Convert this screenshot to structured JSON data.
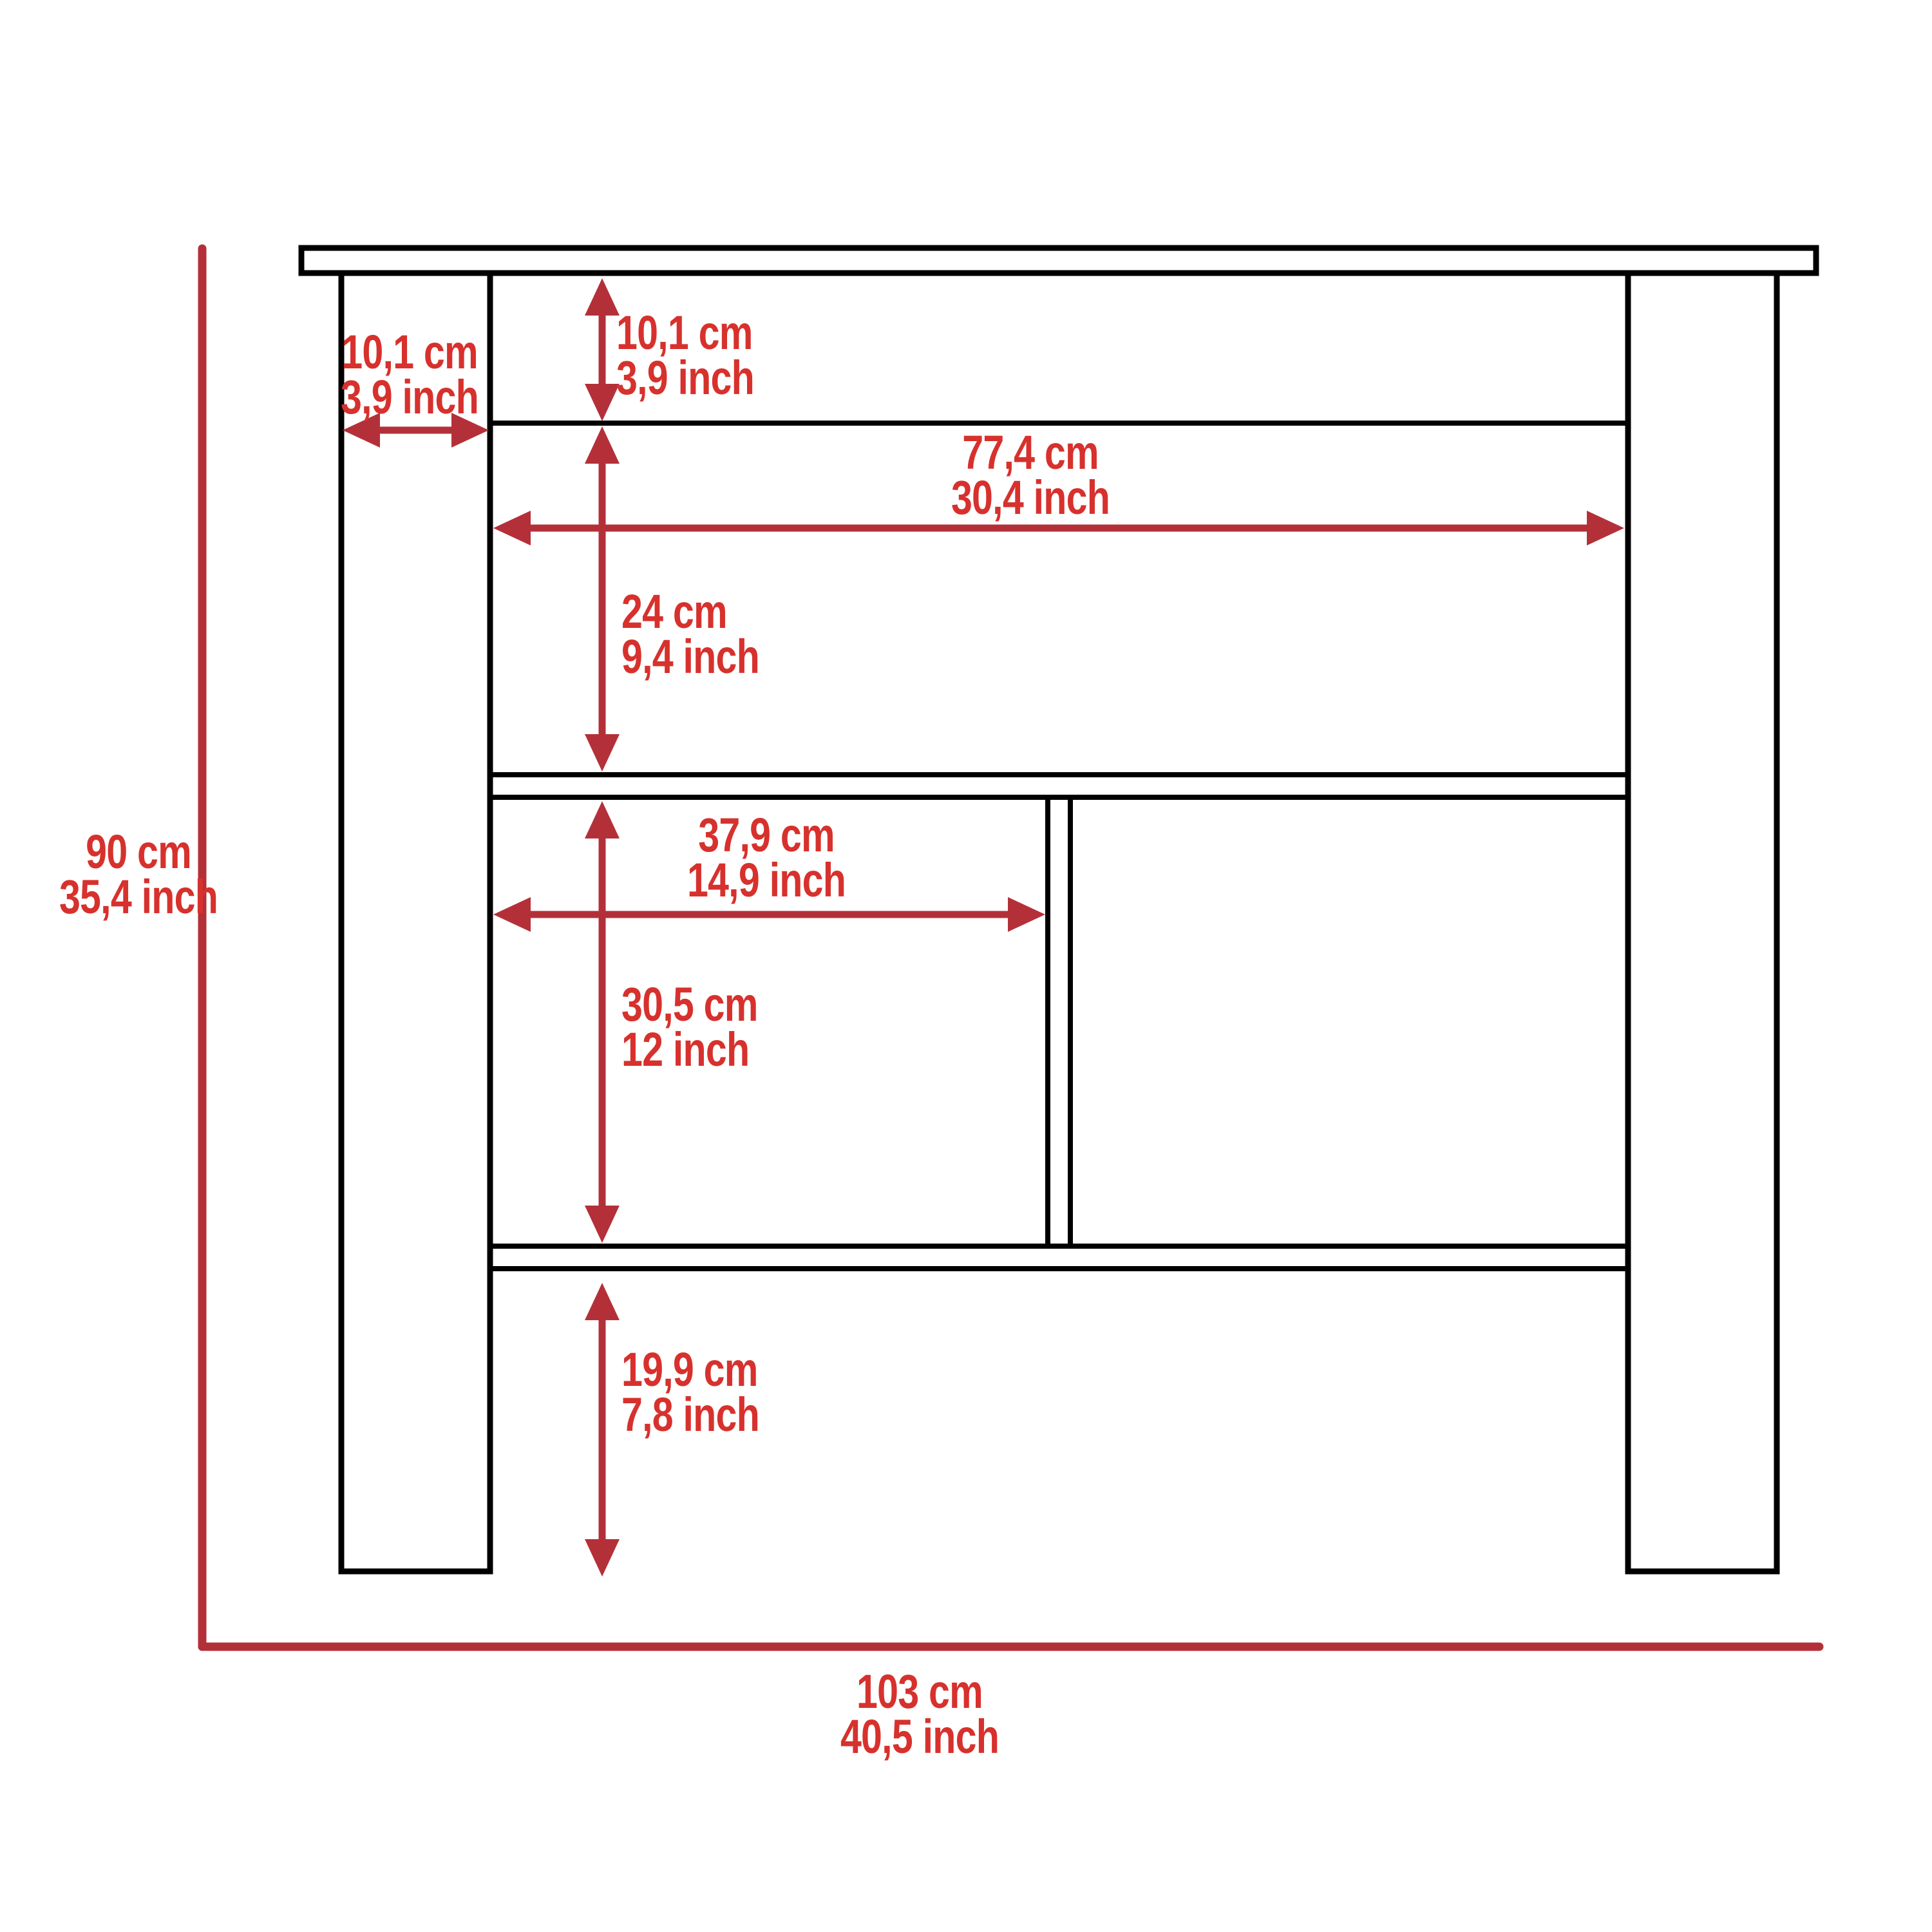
{
  "diagram": {
    "subject": "kitchen-island-front-elevation-dimension-drawing",
    "background": "#FFFFFF",
    "colors": {
      "furniture_outline": "#000000",
      "dimension_line": "#B43039",
      "dimension_text": "#D7312D"
    },
    "units": [
      "cm",
      "inch"
    ],
    "labels": {
      "overall_height": {
        "cm": "90 cm",
        "inch": "35,4 inch"
      },
      "overall_width": {
        "cm": "103 cm",
        "inch": "40,5 inch"
      },
      "leg_width": {
        "cm": "10,1 cm",
        "inch": "3,9 inch"
      },
      "top_shelf_height": {
        "cm": "10,1 cm",
        "inch": "3,9 inch"
      },
      "upper_opening_width": {
        "cm": "77,4 cm",
        "inch": "30,4 inch"
      },
      "upper_opening_height": {
        "cm": "24 cm",
        "inch": "9,4 inch"
      },
      "left_compartment_width": {
        "cm": "37,9 cm",
        "inch": "14,9 inch"
      },
      "compartment_height": {
        "cm": "30,5 cm",
        "inch": "12 inch"
      },
      "bottom_clearance_height": {
        "cm": "19,9 cm",
        "inch": "7,8 inch"
      }
    }
  }
}
